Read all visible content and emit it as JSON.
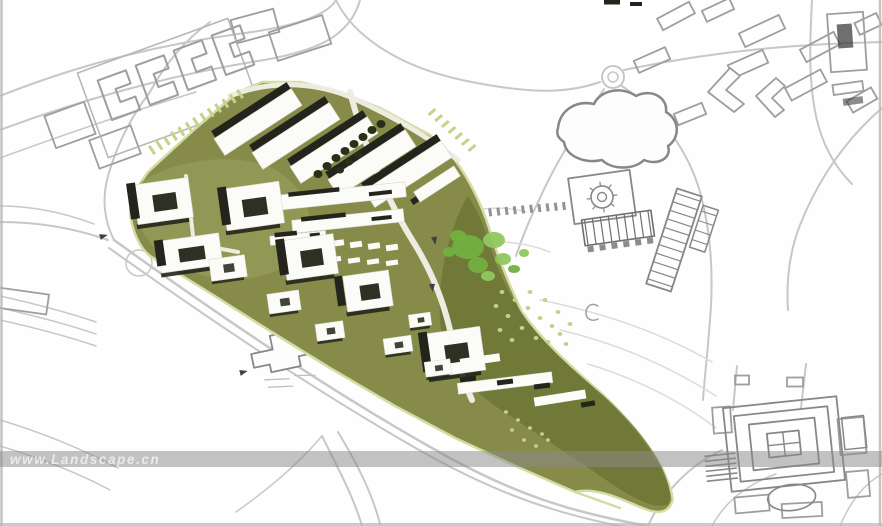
{
  "image": {
    "kind": "architectural-masterplan-site-plan",
    "width": 882,
    "height": 526
  },
  "watermark": {
    "text": "www.Landscape.cn",
    "band_color": "#8a8a8a",
    "band_opacity": 0.52,
    "text_color": "#ededed"
  },
  "palette": {
    "background": "#fefefe",
    "site_olive": "#868b49",
    "site_olive_dark": "#6d7636",
    "site_olive_light": "#9ba25c",
    "site_outline_pale": "#d3dca4",
    "internal_road_white": "#ecede0",
    "building_white": "#fbfbf7",
    "building_shadow_black": "#23251c",
    "courtyard_dark": "#2e3023",
    "tree_dark": "#283019",
    "tree_bright": "#72b040",
    "tree_bright_light": "#8fc75f",
    "speckle_green": "#bdd48c",
    "tick_pale_green": "#c6d189",
    "context_road_gray": "#c7c7c7",
    "context_building_gray": "#9e9e9e",
    "context_detail_gray": "#878787",
    "contour_gray": "#dcdcdc",
    "dark_mark": "#3f3f3f",
    "edge_artifact_gray": "#b5b5b5"
  },
  "layers": [
    "context-linework",
    "development-site",
    "site-buildings",
    "vegetation",
    "watermark"
  ]
}
